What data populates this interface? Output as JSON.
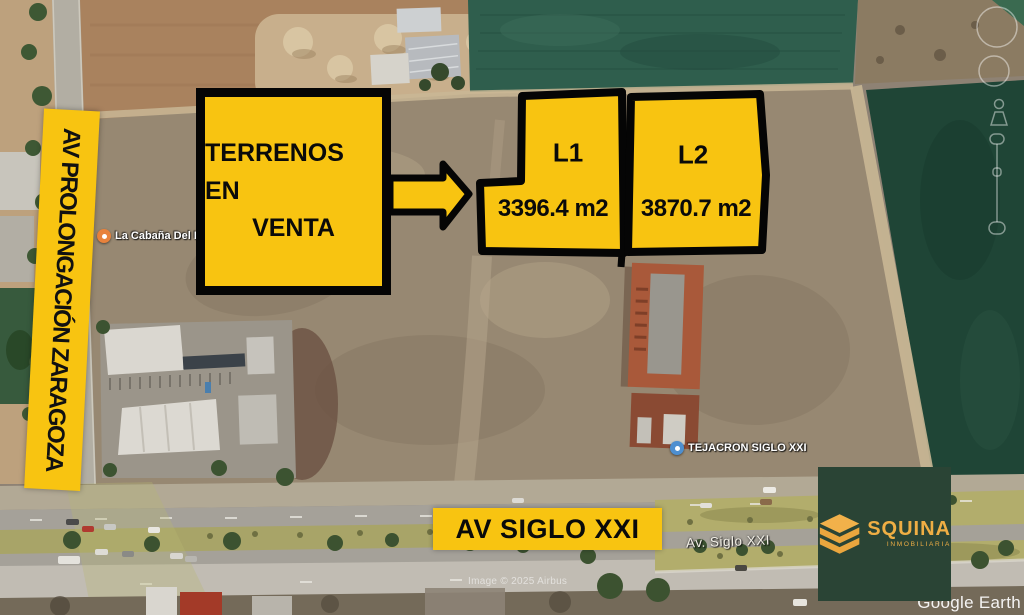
{
  "colors": {
    "accent_yellow": "#F8C411",
    "logo_background": "#2A4435",
    "logo_gold": "#EFAE44",
    "poi_restaurant": "#E8823C",
    "poi_business": "#4E8FD0"
  },
  "signs": {
    "left_road_banner": "AV PROLONGACIÓN ZARAGOZA",
    "main_sign_lines": [
      "TERRENOS EN",
      "VENTA"
    ],
    "bottom_road_banner": "AV SIGLO XXI"
  },
  "lots": [
    {
      "id": "L1",
      "area": "3396.4 m2"
    },
    {
      "id": "L2",
      "area": "3870.7 m2"
    }
  ],
  "map_labels": {
    "restaurant_poi": "La Cabaña Del Llo",
    "business_poi": "TEJACRON SIGLO XXI",
    "road_name": "Av. Siglo XXI"
  },
  "branding": {
    "company": "SQUINA",
    "tagline": "INMOBILIARIA"
  },
  "watermarks": {
    "provider": "Google Earth",
    "attribution": "Image © 2025 Airbus"
  }
}
